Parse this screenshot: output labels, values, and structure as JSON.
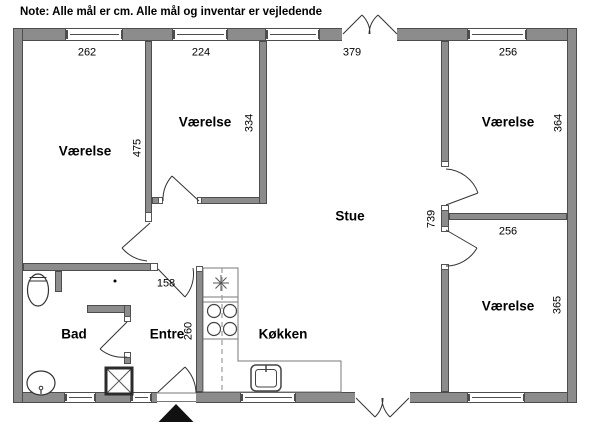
{
  "note": "Note: Alle mål er cm. Alle mål og inventar er vejledende",
  "colors": {
    "wall_fill": "#8c8c8c",
    "wall_outline": "#4d4d4d",
    "line": "#333333"
  },
  "rooms": {
    "vaerelse_nw": {
      "label": "Værelse",
      "width_cm": "262",
      "height_cm": "475"
    },
    "vaerelse_n": {
      "label": "Værelse",
      "width_cm": "224",
      "height_cm": "334"
    },
    "vaerelse_ne": {
      "label": "Værelse",
      "width_cm": "256",
      "height_cm": "364"
    },
    "vaerelse_se": {
      "label": "Værelse",
      "width_cm": "256",
      "height_cm": "365"
    },
    "stue": {
      "label": "Stue",
      "height_cm": "739",
      "top_width_cm": "379"
    },
    "bad": {
      "label": "Bad"
    },
    "entre": {
      "label": "Entre",
      "height_cm": "260",
      "opening_cm": "158"
    },
    "koekken": {
      "label": "Køkken"
    }
  },
  "fixtures": [
    "toilet",
    "bathroom-sink",
    "shower-unit",
    "stove-burners",
    "extractor-fan",
    "kitchen-counter",
    "kitchen-sink",
    "overhead-cabinet-dashed-line",
    "entrance-marker-triangle"
  ]
}
